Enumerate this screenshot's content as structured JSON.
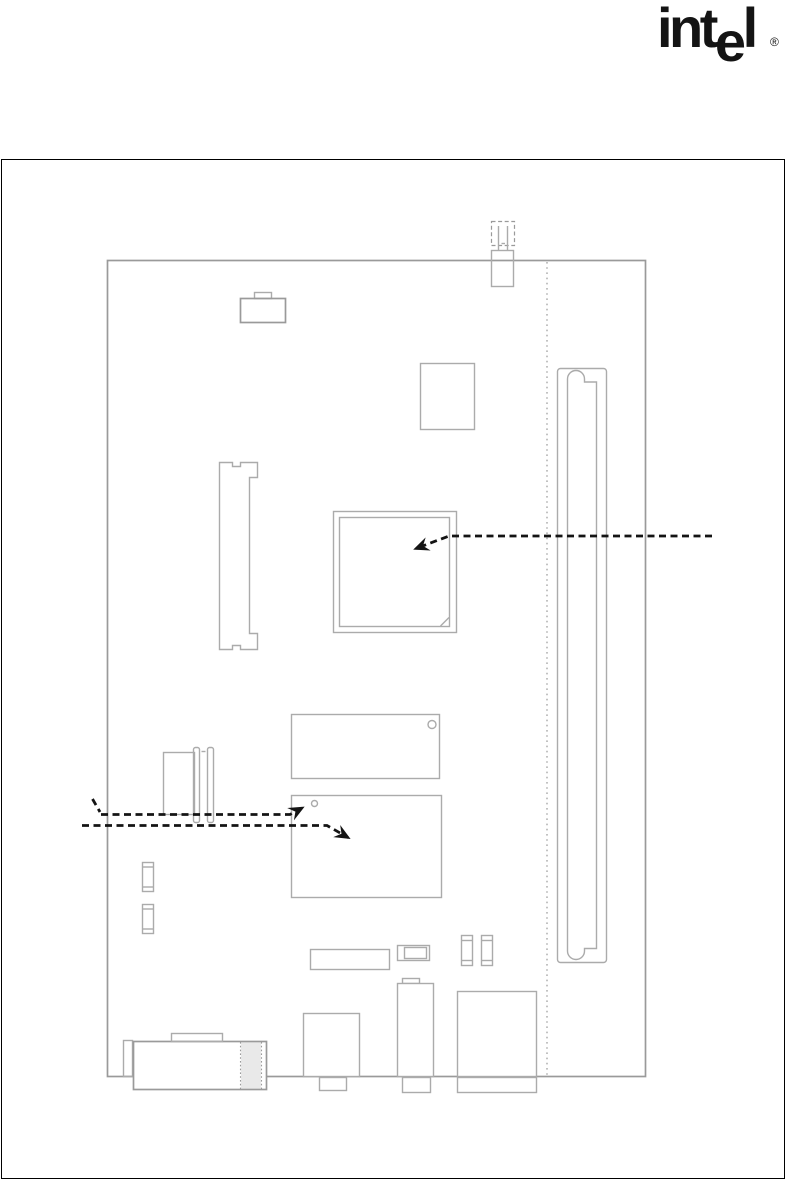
{
  "logo": {
    "pre": "int",
    "dropped": "e",
    "post": "l",
    "registered": "®"
  },
  "colors": {
    "frame": "#000000",
    "outline_light": "#ababab",
    "outline_board": "#9a9a9a",
    "leader": "#141414",
    "band_fill": "#e9e9e9",
    "background": "#ffffff"
  },
  "figure": {
    "type": "motherboard-layout-diagram",
    "text_labels": [],
    "callouts": [
      {
        "name": "processor-callout",
        "direction": "from-right-edge",
        "points_at": "large-square-chip"
      },
      {
        "name": "pin1-marker-callout",
        "direction": "from-left-edge",
        "points_at": "lower-chip-corner-dot"
      },
      {
        "name": "lower-chip-callout",
        "direction": "from-left-edge",
        "points_at": "lower-chip-body"
      }
    ],
    "components": [
      "board-outline",
      "vertical-section-dotted-line",
      "top-edge-connector-with-dashed-cap",
      "battery-like-component",
      "small-square-chip",
      "large-square-chip-with-corner-notch",
      "memory-socket",
      "left-header-connector",
      "upper-mid-chip-with-dot",
      "lower-mid-chip-with-dot",
      "small-capacitor-1",
      "small-capacitor-2",
      "long-low-rectangle",
      "jumper-block",
      "small-jumper-1",
      "small-jumper-2",
      "bottom-edge-connector-1",
      "bottom-edge-connector-2",
      "bottom-edge-connector-3",
      "stacked-io-connector-with-shaded-band",
      "riser-slot"
    ]
  }
}
